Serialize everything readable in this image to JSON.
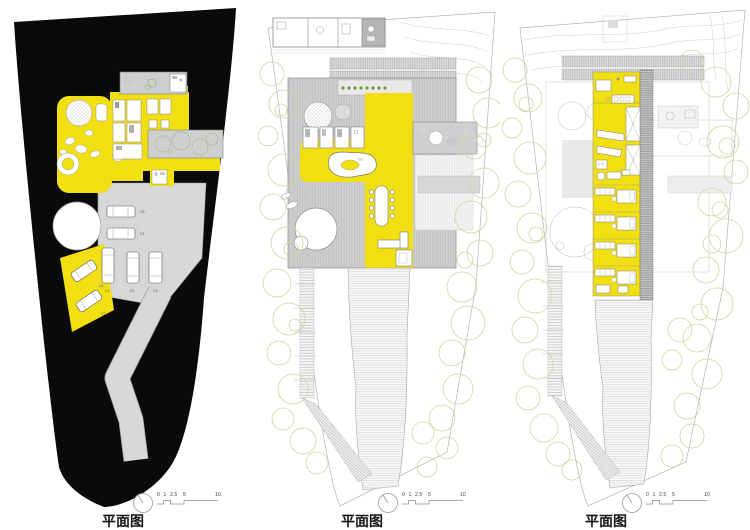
{
  "colors": {
    "highlight_yellow": "#F1DF12",
    "site_black": "#0a0a0a",
    "paving_gray": "#d8d8d8",
    "tree_green": "#ccd79c",
    "plant_green": "#6f9a3c",
    "line_gray": "#9a9a9a",
    "text_dark": "#151515"
  },
  "plans": [
    {
      "label": "平面图"
    },
    {
      "label": "平面图"
    },
    {
      "label": "平面图"
    }
  ],
  "scale_bar": {
    "ticks": [
      "0",
      "1",
      "2.5",
      "5",
      "10"
    ]
  },
  "parking": {
    "car_labels": [
      "C1",
      "C2",
      "C3",
      "C4",
      "C5",
      "C6",
      "C7"
    ]
  }
}
